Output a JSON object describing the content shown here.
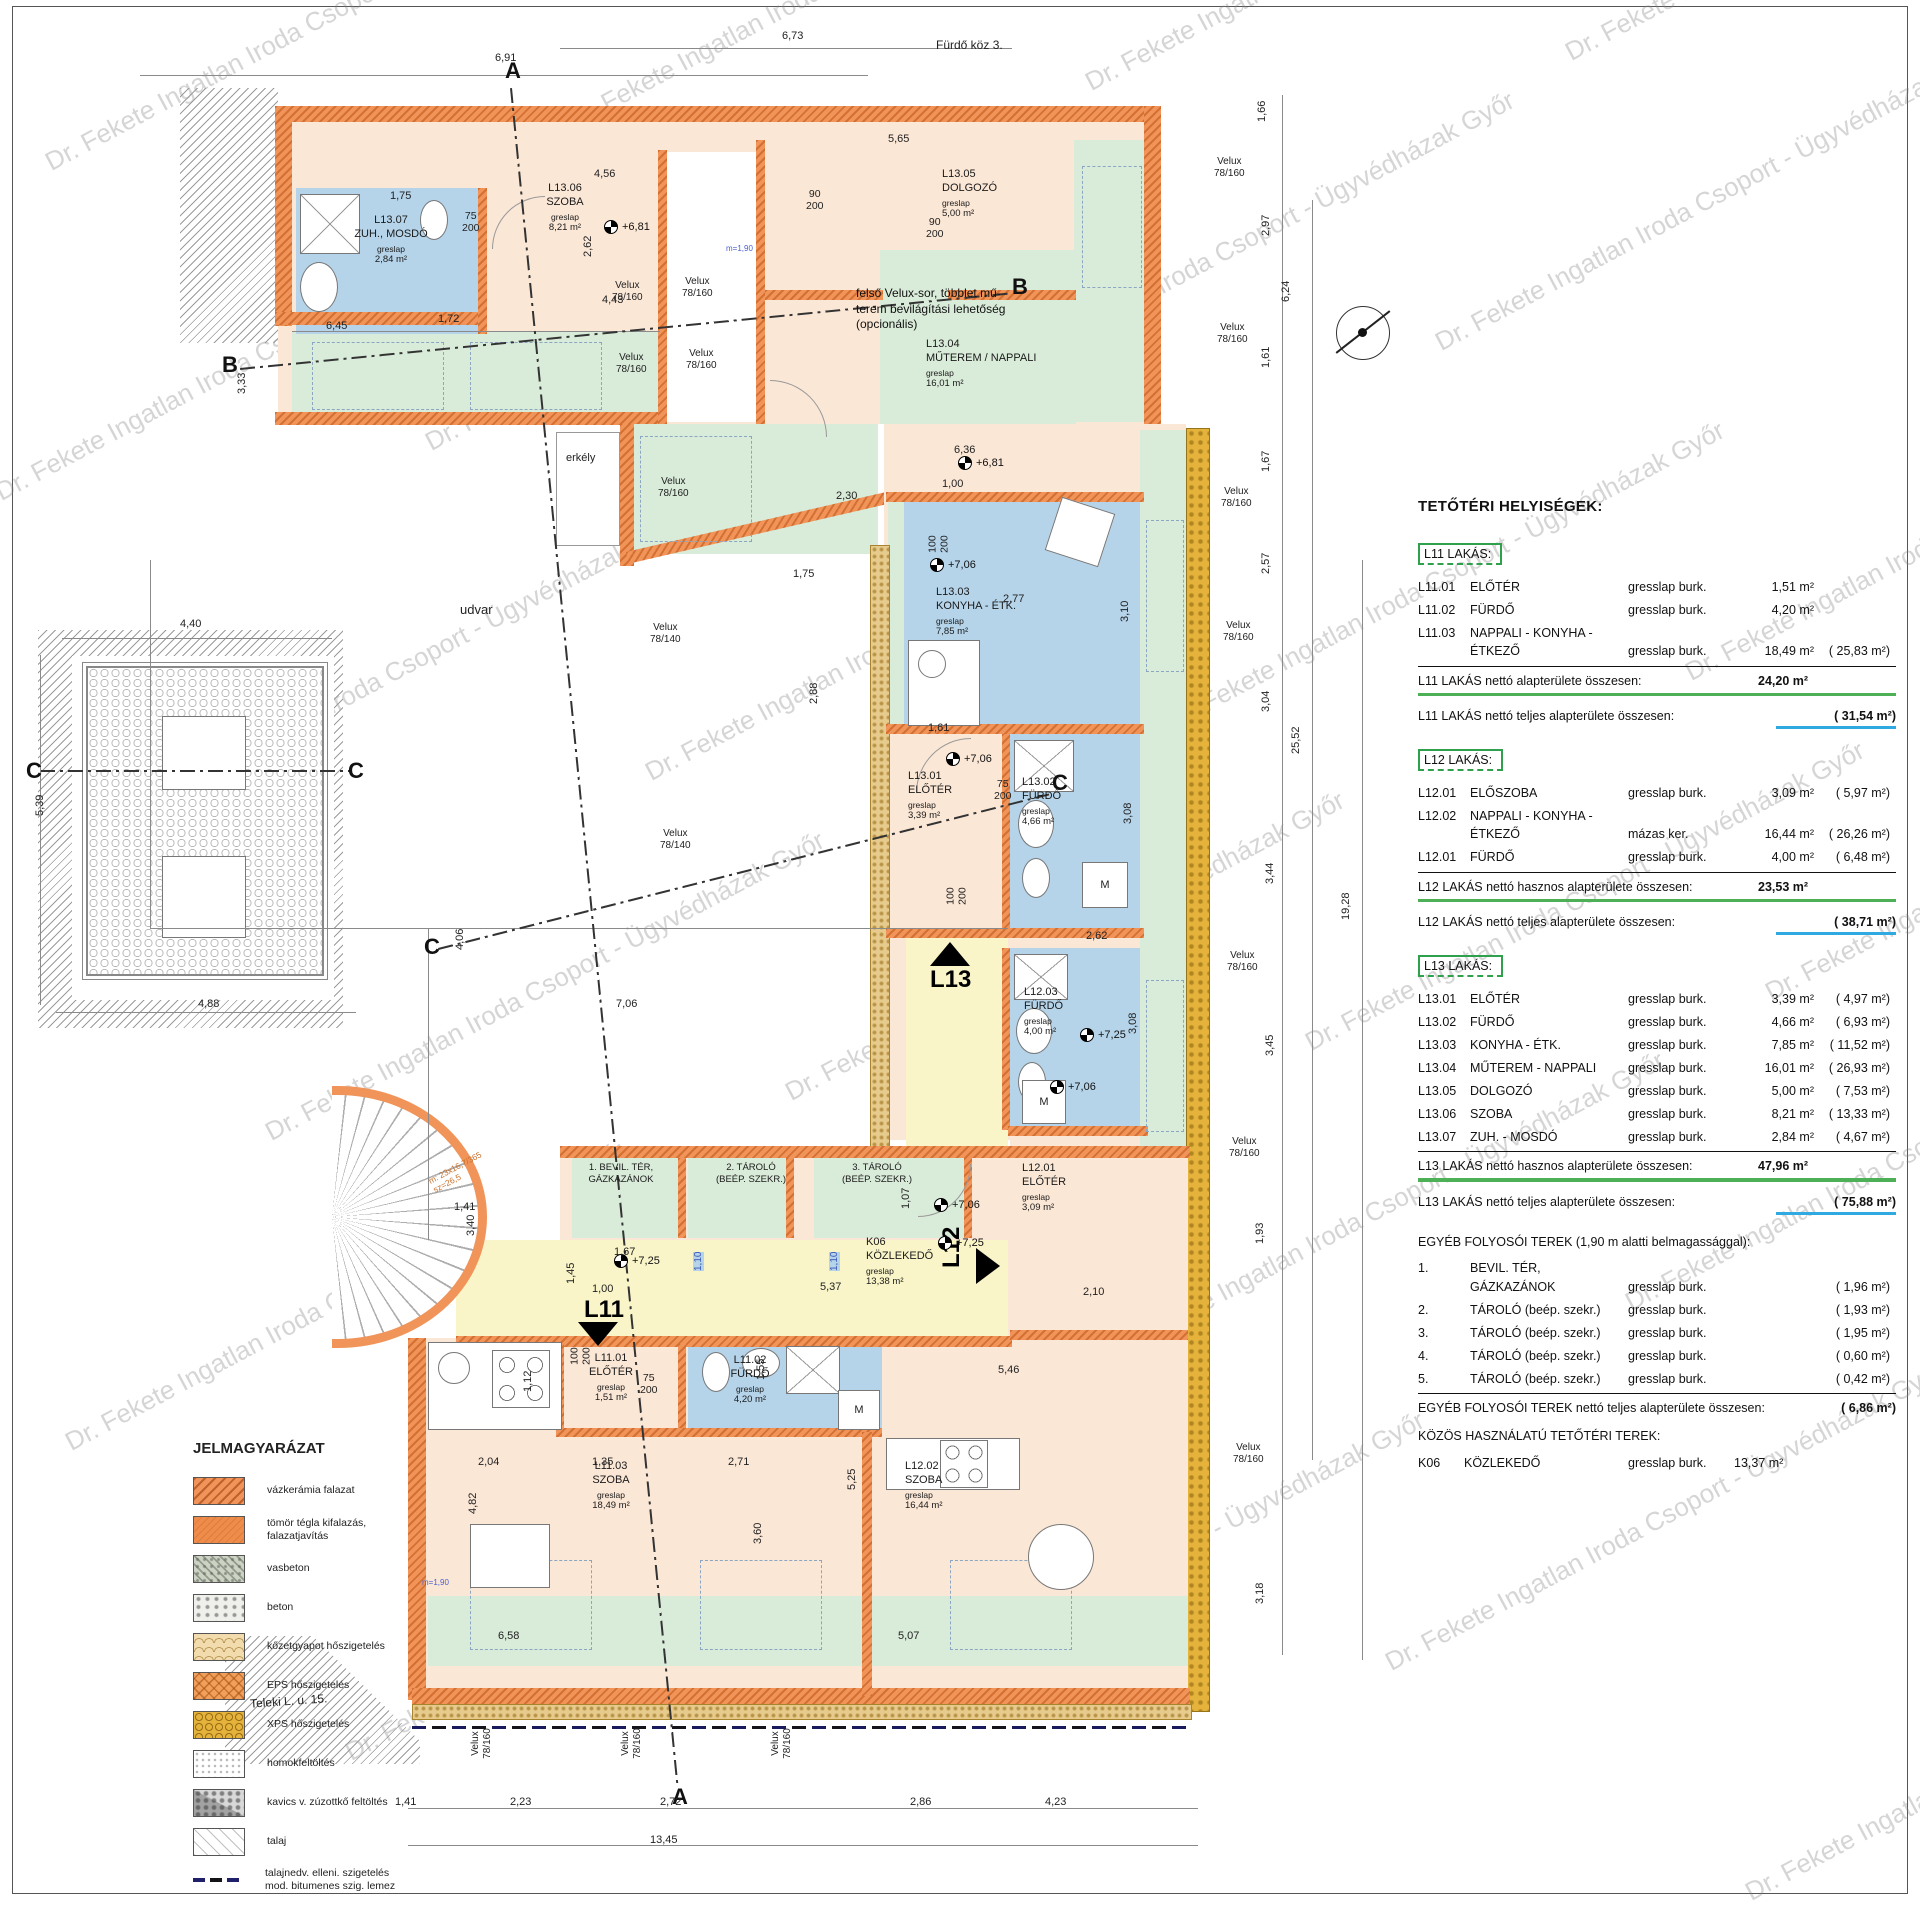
{
  "watermark": "Dr. Fekete Ingatlan Iroda Csoport - Ügyvédházak Győr",
  "site": {
    "street_top": "Fürdő köz 3.",
    "street_bottom": "Teleki L. u. 15.",
    "courtyard": "udvar",
    "balcony": "erkély",
    "velux160": "Velux\n78/160",
    "velux140": "Velux\n78/140",
    "stair_note": "m: 23x16,7/365\nsz=26,5",
    "headroom_mark": "m=1,90",
    "velux_note": "felső Velux-sor, többlet mű-\nterem bevilágítási lehetőség\n(opcionális)"
  },
  "plan": {
    "rooms": [
      {
        "code": "L13.07",
        "name": "ZUH., MOSDÓ",
        "finish": "greslap",
        "area": "2,84 m²"
      },
      {
        "code": "L13.06",
        "name": "SZOBA",
        "finish": "greslap",
        "area": "8,21 m²"
      },
      {
        "code": "L13.05",
        "name": "DOLGOZÓ",
        "finish": "greslap",
        "area": "5,00 m²"
      },
      {
        "code": "L13.04",
        "name": "MŰTEREM / NAPPALI",
        "finish": "greslap",
        "area": "16,01 m²"
      },
      {
        "code": "L13.03",
        "name": "KONYHA - ÉTK.",
        "finish": "greslap",
        "area": "7,85 m²"
      },
      {
        "code": "L13.01",
        "name": "ELŐTÉR",
        "finish": "greslap",
        "area": "3,39 m²"
      },
      {
        "code": "L13.02",
        "name": "FÜRDŐ",
        "finish": "greslap",
        "area": "4,66 m²"
      },
      {
        "code": "L12.03",
        "name": "FÜRDŐ",
        "finish": "greslap",
        "area": "4,00 m²"
      },
      {
        "code": "L12.01",
        "name": "ELŐTÉR",
        "finish": "greslap",
        "area": "3,09 m²"
      },
      {
        "code": "L12.02",
        "name": "SZOBA",
        "finish": "greslap",
        "area": "16,44 m²"
      },
      {
        "code": "L11.01",
        "name": "ELŐTÉR",
        "finish": "greslap",
        "area": "1,51 m²"
      },
      {
        "code": "L11.02",
        "name": "FÜRDŐ",
        "finish": "greslap",
        "area": "4,20 m²"
      },
      {
        "code": "L11.03",
        "name": "SZOBA",
        "finish": "greslap",
        "area": "18,49 m²"
      },
      {
        "code": "K06",
        "name": "KÖZLEKEDŐ",
        "finish": "greslap",
        "area": "13,38 m²"
      }
    ],
    "storages": [
      {
        "no": "1.",
        "l1": "BEVIL. TÉR,",
        "l2": "GÁZKAZÁNOK"
      },
      {
        "no": "2.",
        "l1": "TÁROLÓ",
        "l2": "(BEÉP. SZEKR.)"
      },
      {
        "no": "3.",
        "l1": "TÁROLÓ",
        "l2": "(BEÉP. SZEKR.)"
      }
    ],
    "entrances": [
      "L11",
      "L12",
      "L13"
    ],
    "levels": [
      "+6,81",
      "+7,06",
      "+7,25"
    ],
    "door_dims": [
      "75\n200",
      "90\n200",
      "100\n200"
    ],
    "section_letters": [
      "A",
      "B",
      "C"
    ],
    "dims": [
      "6,91",
      "6,73",
      "1,66",
      "2,97",
      "6,24",
      "1,61",
      "1,67",
      "2,57",
      "3,04",
      "25,52",
      "3,44",
      "19,28",
      "3,45",
      "1,93",
      "3,18",
      "4,40",
      "5,39",
      "4,88",
      "1,41",
      "2,23",
      "2,72",
      "2,86",
      "4,23",
      "13,45",
      "3,33",
      "6,45",
      "5,65",
      "4,56",
      "2,30",
      "6,36",
      "1,00",
      "5,46",
      "2,71",
      "1,35",
      "2,04",
      "3,60",
      "5,25",
      "2,10",
      "5,37",
      "2,62",
      "2,77",
      "1,61",
      "7,06",
      "4,06",
      "6,58",
      "5,07",
      "1,10",
      "1,10",
      "1,75",
      "1,72",
      "2,88",
      "1,75",
      "3,10",
      "3,08",
      "3,08",
      "2,62",
      "4,43",
      "4,82",
      "1,12",
      "1,55",
      "1,07",
      "1,45",
      "1,67",
      "1,00",
      "1,41",
      "3,40"
    ]
  },
  "schedule": {
    "title": "TETŐTÉRI HELYISÉGEK:",
    "groups": [
      {
        "header": "L11 LAKÁS:",
        "rows": [
          {
            "code": "L11.01",
            "name": "ELŐTÉR",
            "name2": "",
            "finish": "gresslap burk.",
            "net": "1,51 m²",
            "gross": ""
          },
          {
            "code": "L11.02",
            "name": "FÜRDŐ",
            "name2": "",
            "finish": "gresslap burk.",
            "net": "4,20 m²",
            "gross": ""
          },
          {
            "code": "L11.03",
            "name": "NAPPALI - KONYHA -",
            "name2": "ÉTKEZŐ",
            "finish": "gresslap burk.",
            "net": "18,49 m²",
            "gross": "(  25,83 m²)"
          }
        ],
        "subtotal_label": "L11 LAKÁS nettó alapterülete összesen:",
        "subtotal_value": "24,20 m²",
        "total_label": "L11 LAKÁS nettó teljes alapterülete összesen:",
        "total_value": "(  31,54 m²)"
      },
      {
        "header": "L12 LAKÁS:",
        "rows": [
          {
            "code": "L12.01",
            "name": "ELŐSZOBA",
            "name2": "",
            "finish": "gresslap burk.",
            "net": "3,09 m²",
            "gross": "(  5,97 m²)"
          },
          {
            "code": "L12.02",
            "name": "NAPPALI - KONYHA -",
            "name2": "ÉTKEZŐ",
            "finish": "mázas ker.",
            "net": "16,44 m²",
            "gross": "(  26,26 m²)"
          },
          {
            "code": "L12.01",
            "name": "FÜRDŐ",
            "name2": "",
            "finish": "gresslap burk.",
            "net": "4,00 m²",
            "gross": "(  6,48 m²)"
          }
        ],
        "subtotal_label": "L12 LAKÁS nettó hasznos alapterülete összesen:",
        "subtotal_value": "23,53 m²",
        "total_label": "L12 LAKÁS nettó teljes alapterülete összesen:",
        "total_value": "(  38,71 m²)"
      },
      {
        "header": "L13 LAKÁS:",
        "rows": [
          {
            "code": "L13.01",
            "name": "ELŐTÉR",
            "name2": "",
            "finish": "gresslap burk.",
            "net": "3,39 m²",
            "gross": "(  4,97 m²)"
          },
          {
            "code": "L13.02",
            "name": "FÜRDŐ",
            "name2": "",
            "finish": "gresslap burk.",
            "net": "4,66 m²",
            "gross": "(  6,93 m²)"
          },
          {
            "code": "L13.03",
            "name": "KONYHA - ÉTK.",
            "name2": "",
            "finish": "gresslap burk.",
            "net": "7,85 m²",
            "gross": "(  11,52 m²)"
          },
          {
            "code": "L13.04",
            "name": "MŰTEREM - NAPPALI",
            "name2": "",
            "finish": "gresslap burk.",
            "net": "16,01 m²",
            "gross": "(  26,93 m²)"
          },
          {
            "code": "L13.05",
            "name": "DOLGOZÓ",
            "name2": "",
            "finish": "gresslap burk.",
            "net": "5,00 m²",
            "gross": "(  7,53 m²)"
          },
          {
            "code": "L13.06",
            "name": "SZOBA",
            "name2": "",
            "finish": "gresslap burk.",
            "net": "8,21 m²",
            "gross": "(  13,33 m²)"
          },
          {
            "code": "L13.07",
            "name": "ZUH. - MOSDÓ",
            "name2": "",
            "finish": "gresslap burk.",
            "net": "2,84 m²",
            "gross": "(  4,67 m²)"
          }
        ],
        "subtotal_label": "L13 LAKÁS nettó hasznos alapterülete összesen:",
        "subtotal_value": "47,96 m²",
        "total_label": "L13 LAKÁS nettó teljes alapterülete összesen:",
        "total_value": "(  75,88 m²)"
      }
    ],
    "other": {
      "header": "EGYÉB FOLYOSÓI TEREK (1,90 m alatti belmagassággal):",
      "rows": [
        {
          "code": "1.",
          "name": "BEVIL. TÉR,",
          "name2": "GÁZKAZÁNOK",
          "finish": "gresslap burk.",
          "gross": "(  1,96 m²)"
        },
        {
          "code": "2.",
          "name": "TÁROLÓ (beép. szekr.)",
          "name2": "",
          "finish": "gresslap burk.",
          "gross": "(  1,93 m²)"
        },
        {
          "code": "3.",
          "name": "TÁROLÓ (beép. szekr.)",
          "name2": "",
          "finish": "gresslap burk.",
          "gross": "(  1,95 m²)"
        },
        {
          "code": "4.",
          "name": "TÁROLÓ (beép. szekr.)",
          "name2": "",
          "finish": "gresslap burk.",
          "gross": "(  0,60 m²)"
        },
        {
          "code": "5.",
          "name": "TÁROLÓ (beép. szekr.)",
          "name2": "",
          "finish": "gresslap burk.",
          "gross": "(  0,42 m²)"
        }
      ],
      "total_label": "EGYÉB FOLYOSÓI TEREK nettó teljes alapterülete összesen:",
      "total_value": "(  6,86 m²)"
    },
    "common": {
      "header": "KÖZÖS HASZNÁLATÚ TETŐTÉRI TEREK:",
      "rows": [
        {
          "code": "K06",
          "name": "KÖZLEKEDŐ",
          "finish": "gresslap burk.",
          "net": "13,37 m²"
        }
      ]
    }
  },
  "legend": {
    "title": "JELMAGYARÁZAT",
    "items": [
      "vázkerámia falazat",
      "tömör tégla kifalazás,\nfalazatjavítás",
      "vasbeton",
      "beton",
      "kőzetgyapot hőszigetelés",
      "EPS hőszigetelés",
      "XPS hőszigetelés",
      "homokfeltöltés",
      "kavics v. zúzottkő feltöltés",
      "talaj",
      "talajnedv. elleni. szigetelés\nmod. bitumenes szig. lemez"
    ]
  }
}
